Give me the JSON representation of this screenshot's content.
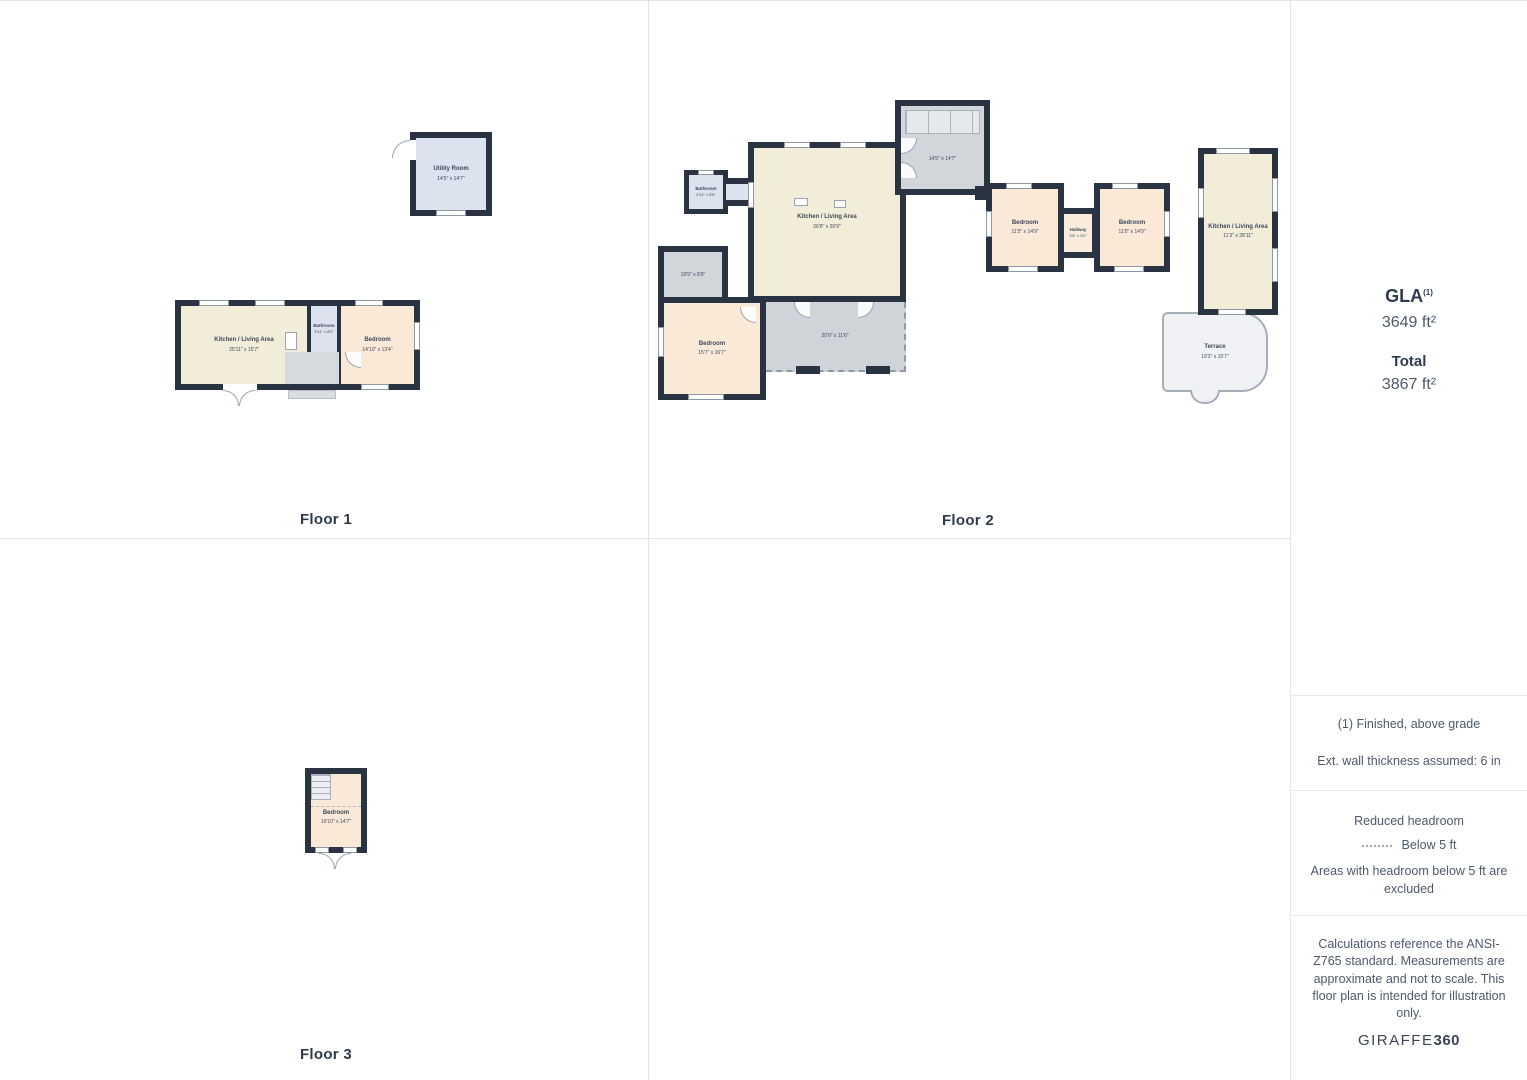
{
  "floors": {
    "floor1": {
      "label": "Floor 1",
      "utility": {
        "name": "Utility Room",
        "dims": "14'5\" x 14'7\""
      },
      "kitchen": {
        "name": "Kitchen / Living Area",
        "dims": "25'11\" x 15'7\""
      },
      "bathroom": {
        "name": "Bathroom",
        "dims": "3'11\" x 8'2\""
      },
      "bedroom": {
        "name": "Bedroom",
        "dims": "14'10\" x 13'4\""
      }
    },
    "floor2": {
      "label": "Floor 2",
      "bathroom": {
        "name": "Bathroom",
        "dims": "5'11\" x 5'5\""
      },
      "kitchen": {
        "name": "Kitchen / Living Area",
        "dims": "26'8\" x 26'9\""
      },
      "stair_room": {
        "dims": "14'5\" x 14'7\""
      },
      "storage": {
        "dims": "10'5\" x 8'9\""
      },
      "bedroom_sw": {
        "name": "Bedroom",
        "dims": "15'7\" x 16'7\""
      },
      "reduced_headroom": {
        "dims": "20'9\" x 11'6\""
      },
      "bedroom_w": {
        "name": "Bedroom",
        "dims": "11'5\" x 14'9\""
      },
      "hallway": {
        "name": "Hallway",
        "dims": "3'6\" x 3'0\""
      },
      "bedroom_e": {
        "name": "Bedroom",
        "dims": "11'5\" x 14'9\""
      },
      "kitchen_e": {
        "name": "Kitchen / Living Area",
        "dims": "11'3\" x 28'11\""
      },
      "terrace": {
        "name": "Terrace",
        "dims": "19'3\" x 15'7\""
      }
    },
    "floor3": {
      "label": "Floor 3",
      "bedroom": {
        "name": "Bedroom",
        "dims": "10'10\" x 14'7\""
      }
    }
  },
  "sidebar": {
    "gla_label": "GLA",
    "gla_sup": "(1)",
    "gla_value": "3649 ft²",
    "total_label": "Total",
    "total_value": "3867 ft²",
    "note_finished": "(1) Finished, above grade",
    "note_wall": "Ext. wall thickness assumed: 6 in",
    "headroom_title": "Reduced headroom",
    "headroom_legend": "Below 5 ft",
    "headroom_note": "Areas with headroom below 5 ft are excluded",
    "disclaimer": "Calculations reference the ANSI-Z765 standard. Measurements are approximate and not to scale. This floor plan is intended for illustration only.",
    "brand_giraffe": "GIRAFFE",
    "brand_360": "360"
  },
  "colors": {
    "wall": "#2a3342",
    "kitchen_fill": "#f2edd9",
    "bedroom_fill": "#fbe9d8",
    "bathroom_fill": "#dce2ee",
    "stair_fill": "#d2d6db",
    "terrace_fill": "#eff1f4"
  }
}
